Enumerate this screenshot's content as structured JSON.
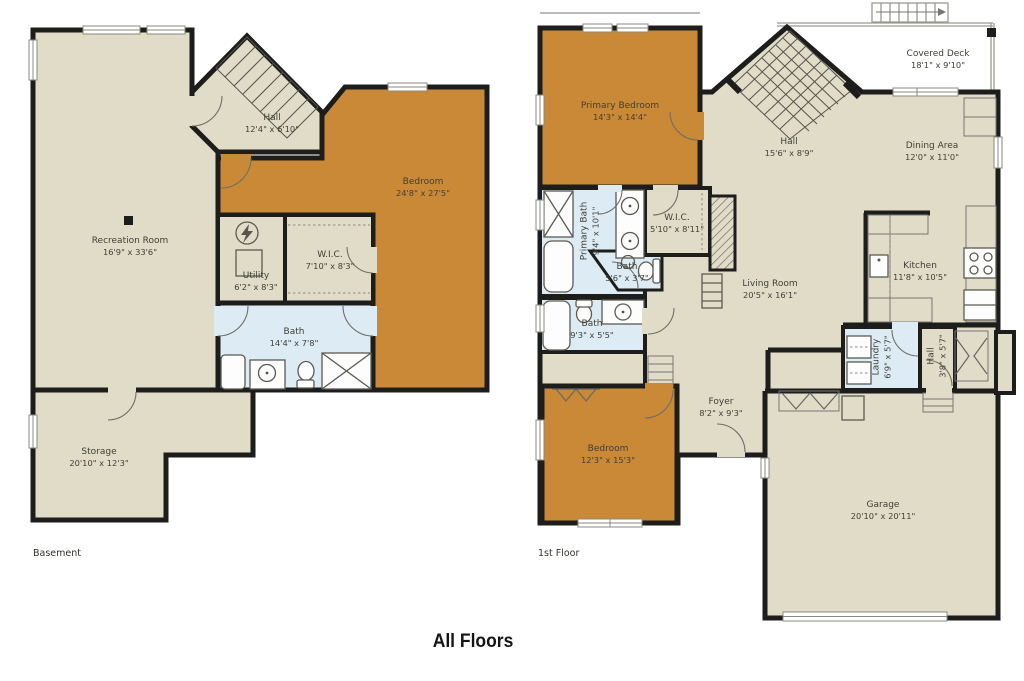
{
  "title": "All Floors",
  "colors": {
    "floor_tan": "#e0dcc8",
    "bedroom_orange": "#c98936",
    "bath_blue": "#dcebf4",
    "wall": "#1d1d1b"
  },
  "floors": {
    "basement": {
      "label": "Basement",
      "rooms": {
        "recreation": {
          "name": "Recreation Room",
          "dims": "16'9\" x 33'6\""
        },
        "hall": {
          "name": "Hall",
          "dims": "12'4\" x 6'10\""
        },
        "bedroom": {
          "name": "Bedroom",
          "dims": "24'8\" x 27'5\""
        },
        "wic": {
          "name": "W.I.C.",
          "dims": "7'10\" x 8'3\""
        },
        "utility": {
          "name": "Utility",
          "dims": "6'2\" x 8'3\""
        },
        "bath": {
          "name": "Bath",
          "dims": "14'4\" x 7'8\""
        },
        "storage": {
          "name": "Storage",
          "dims": "20'10\" x 12'3\""
        }
      }
    },
    "first": {
      "label": "1st Floor",
      "rooms": {
        "primary_bedroom": {
          "name": "Primary Bedroom",
          "dims": "14'3\" x 14'4\""
        },
        "hall": {
          "name": "Hall",
          "dims": "15'6\" x 8'9\""
        },
        "covered_deck": {
          "name": "Covered Deck",
          "dims": "18'1\" x 9'10\""
        },
        "dining": {
          "name": "Dining Area",
          "dims": "12'0\" x 11'0\""
        },
        "primary_bath": {
          "name": "Primary Bath",
          "dims": "9'4\" x 10'1\""
        },
        "wic": {
          "name": "W.I.C.",
          "dims": "5'10\" x 8'11\""
        },
        "bath_small": {
          "name": "Bath",
          "dims": "5'6\" x 3'7\""
        },
        "bath": {
          "name": "Bath",
          "dims": "9'3\" x 5'5\""
        },
        "living": {
          "name": "Living Room",
          "dims": "20'5\" x 16'1\""
        },
        "kitchen": {
          "name": "Kitchen",
          "dims": "11'8\" x 10'5\""
        },
        "laundry": {
          "name": "Laundry",
          "dims": "6'9\" x 5'7\""
        },
        "hall_small": {
          "name": "Hall",
          "dims": "3'8\" x 5'7\""
        },
        "foyer": {
          "name": "Foyer",
          "dims": "8'2\" x 9'3\""
        },
        "bedroom": {
          "name": "Bedroom",
          "dims": "12'3\" x 15'3\""
        },
        "garage": {
          "name": "Garage",
          "dims": "20'10\" x 20'11\""
        }
      }
    }
  }
}
